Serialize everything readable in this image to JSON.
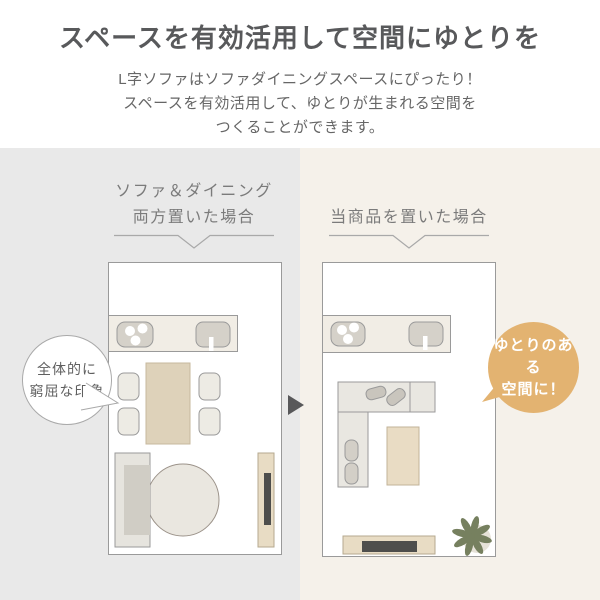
{
  "header": {
    "title": "スペースを有効活用して空間にゆとりを",
    "subtitle_lines": [
      "L字ソファはソファダイニングスペースにぴったり！",
      "スペースを有効活用して、ゆとりが生まれる空間を",
      "つくることができます。"
    ]
  },
  "comparison": {
    "left_panel": {
      "label_lines": [
        "ソファ＆ダイニング",
        "両方置いた場合"
      ],
      "bubble_lines": [
        "全体的に",
        "窮屈な印象"
      ],
      "bg_color": "#e9e9e9"
    },
    "right_panel": {
      "label": "当商品を置いた場合",
      "badge_lines": [
        "ゆとりのある",
        "空間に！"
      ],
      "bg_color": "#f5f1ea",
      "badge_color": "#e3b371"
    }
  },
  "icons": {
    "arrow": "right-triangle-arrow",
    "plant": "houseplant-top-view",
    "stove": "three-burner-stove-top-view",
    "sink": "kitchen-sink-top-view"
  },
  "colors": {
    "title_text": "#58595b",
    "body_text": "#666666",
    "label_text": "#7b7b7b",
    "arrow": "#58585a",
    "plant_green": "#76805f",
    "wood_beige": "#ded2ba",
    "floor_border": "#9a9a9a"
  }
}
